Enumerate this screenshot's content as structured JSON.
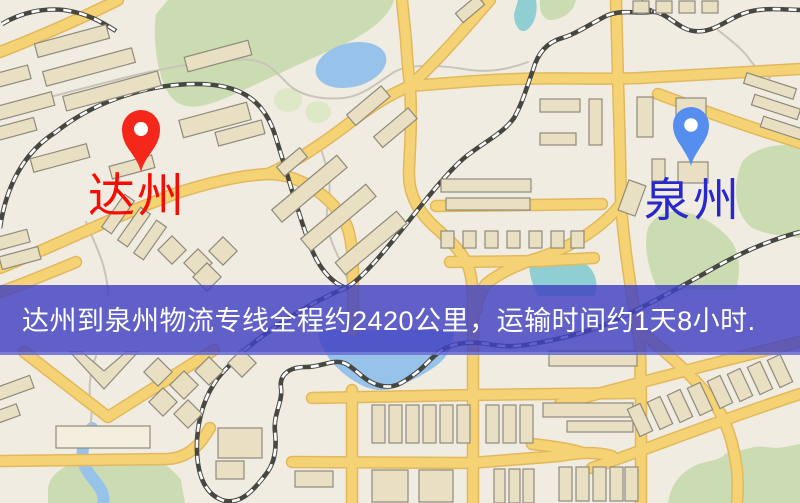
{
  "map": {
    "origin": {
      "name": "达州"
    },
    "destination": {
      "name": "泉州"
    },
    "banner": {
      "text": "达州到泉州物流专线全程约2420公里，运输时间约1天8小时."
    },
    "colors": {
      "land": "#f1ece1",
      "road_fill": "#f5d374",
      "road_casing": "#e2b85f",
      "water": "#97c3ea",
      "water_teal": "#8fcfd4",
      "green": "#ccdcb2",
      "green_light": "#dfe8c6",
      "building_fill": "#e9e0c4",
      "building_stroke": "#8f8a7c",
      "railway": "#474742",
      "path_gray": "#c9c4ba",
      "origin_label": "#f30d02",
      "origin_pin": "#f5271b",
      "destination_label": "#2828cc",
      "destination_pin": "#568ef0",
      "banner_bg": "rgba(65,65,194,0.82)",
      "banner_text": "#ffffff"
    }
  }
}
